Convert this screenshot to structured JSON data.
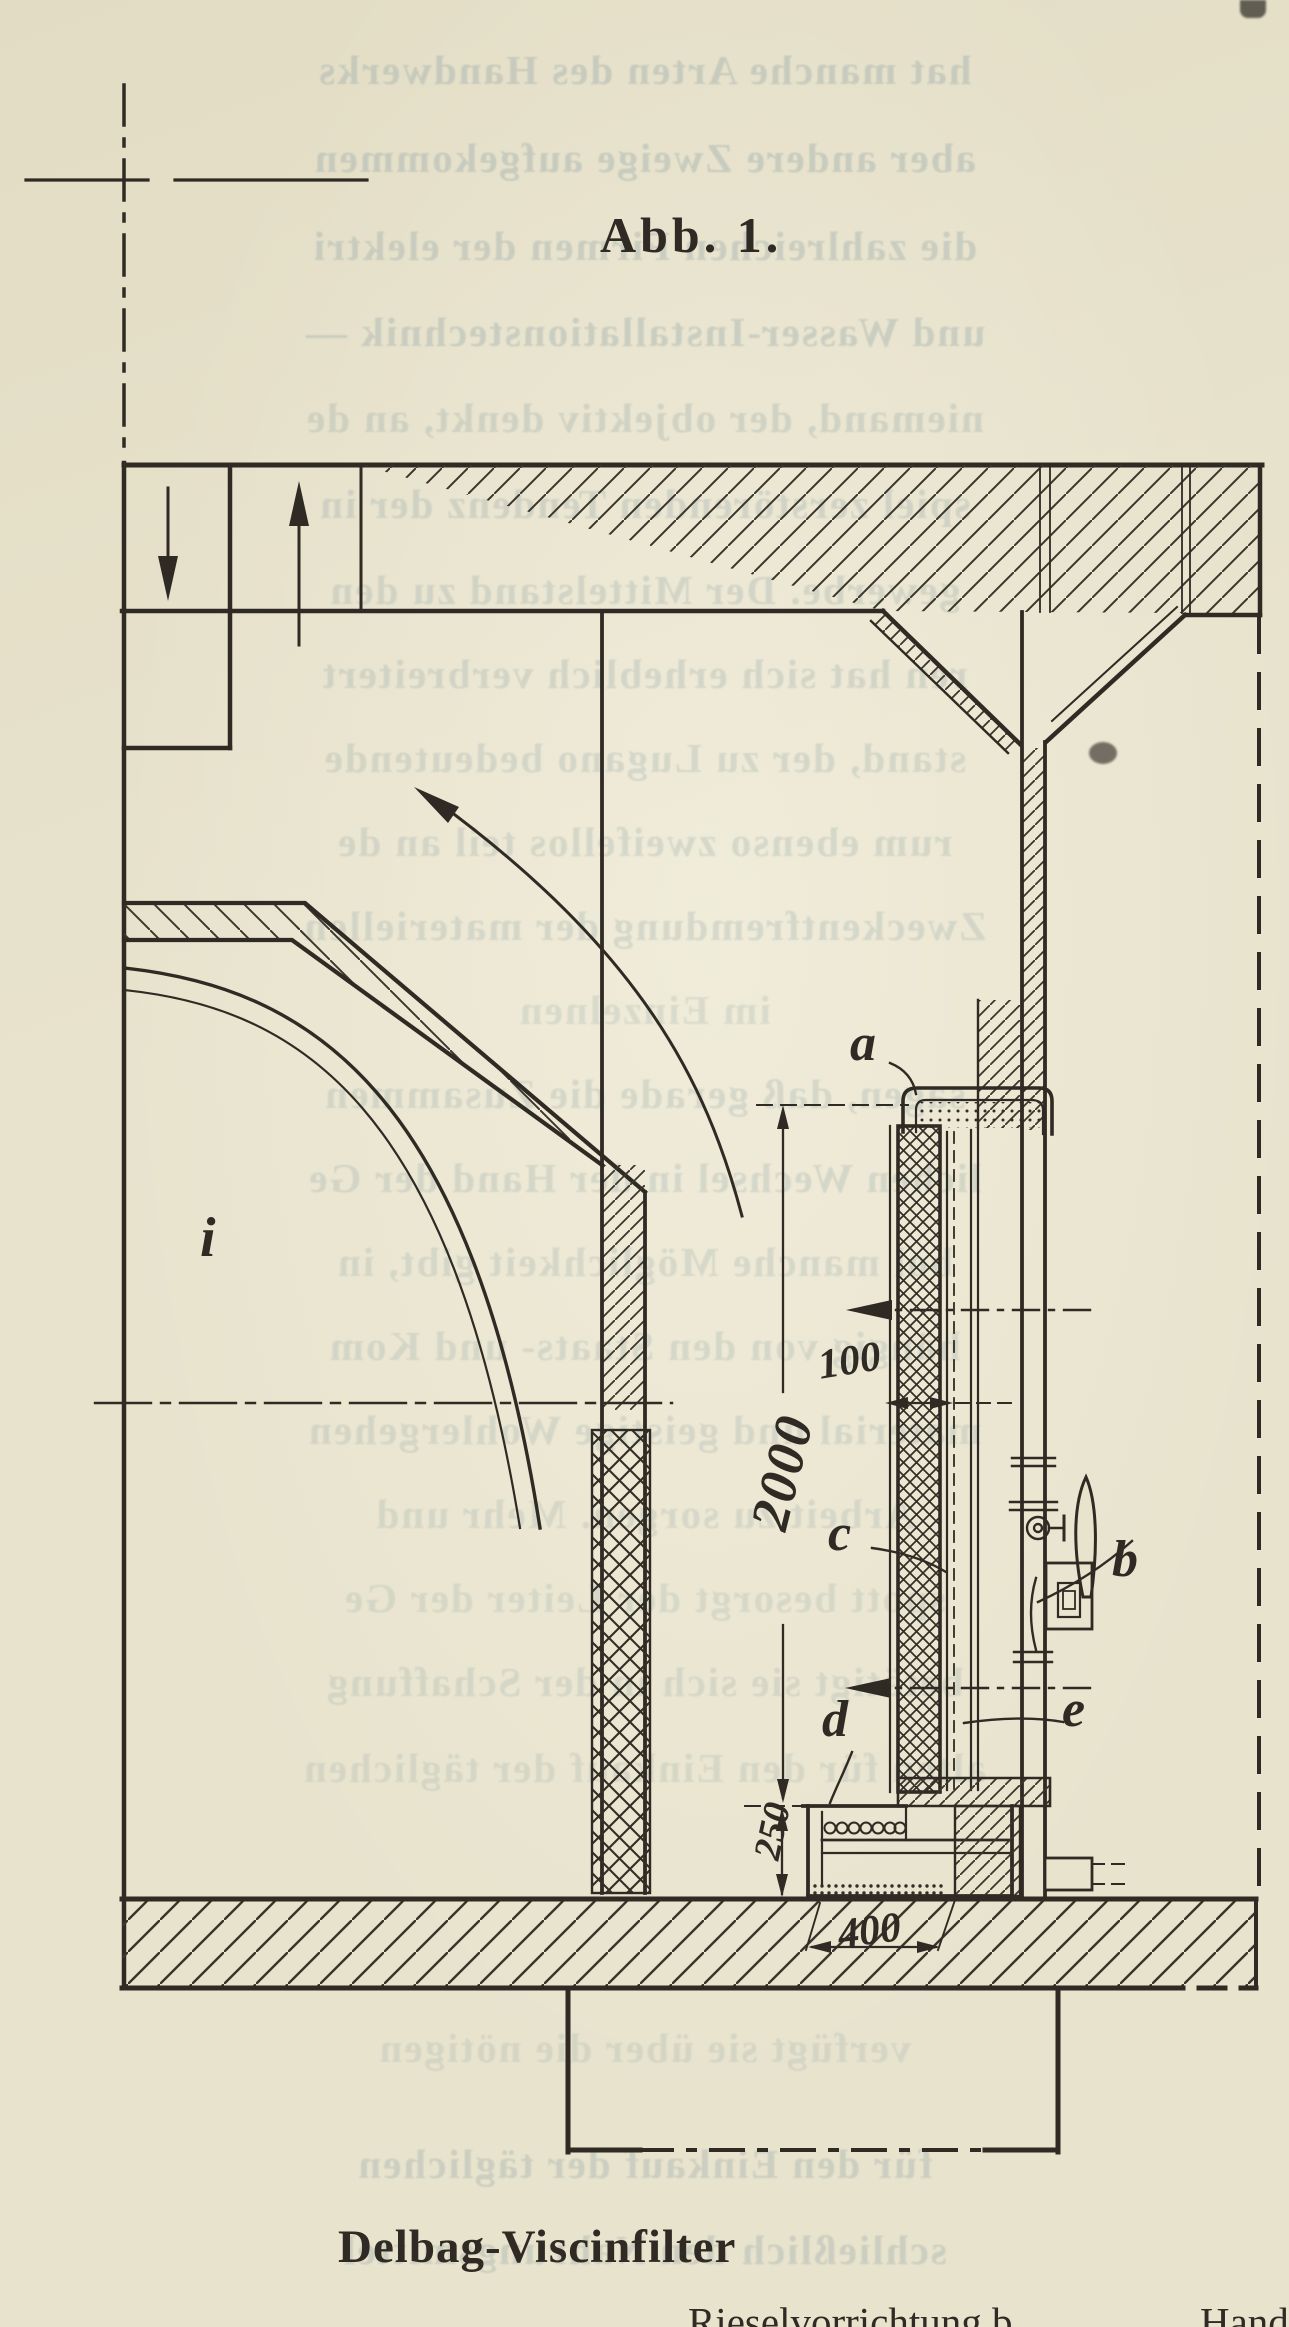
{
  "page": {
    "background_color": "#e8e3cd",
    "ink_color": "#2f2a23",
    "bleed_text_color": "#a9b6b1"
  },
  "figure": {
    "label": "Abb. 1.",
    "caption": "Delbag-Viscinfilter",
    "caption_continuation_part1": "Rieselvorrichtung b",
    "caption_continuation_part2": "Hand"
  },
  "diagram": {
    "type": "sectional engineering drawing of a Delbag Viscin air filter installed in a masonry duct",
    "part_labels": {
      "a": "a",
      "b": "b",
      "c": "c",
      "d": "d",
      "e": "e",
      "i": "i"
    },
    "dimensions_mm": {
      "filter_thickness": "100",
      "filter_height": "2000",
      "sump_height": "250",
      "trough_width": "400"
    },
    "flow_arrows": [
      "down-arrow in left shaft",
      "up-arrow in outlet shaft",
      "curved arrow from chamber to bell-mouth",
      "two horizontal arrows pointing left through filter"
    ]
  },
  "bleed_text": {
    "note": "mirrored show-through of the reverse page, German serif type",
    "lines": [
      {
        "y": 46,
        "opacity": 0.5,
        "text": "hat manche Arten des Handwerks"
      },
      {
        "y": 134,
        "opacity": 0.5,
        "text": "aber andere Zweige aufgekommen"
      },
      {
        "y": 222,
        "opacity": 0.48,
        "text": "die zahlreichen Firmen der elektri"
      },
      {
        "y": 308,
        "opacity": 0.48,
        "text": "und Wasser-Installationstechnik —"
      },
      {
        "y": 394,
        "opacity": 0.4,
        "text": "niemand, der objektiv denkt, an de"
      },
      {
        "y": 480,
        "opacity": 0.4,
        "text": "spiel zerstörenden Tendenz der in"
      },
      {
        "y": 566,
        "opacity": 0.38,
        "text": "gewerbe. Der Mittelstand zu den"
      },
      {
        "y": 650,
        "opacity": 0.38,
        "text": "ren hat sich erheblich verbreitert"
      },
      {
        "y": 734,
        "opacity": 0.36,
        "text": "stand, der zu Lugano bedeutende"
      },
      {
        "y": 818,
        "opacity": 0.36,
        "text": "rum ebenso zweifellos teil an de"
      },
      {
        "y": 902,
        "opacity": 0.36,
        "text": "Zweckentfremdung der materiellen"
      },
      {
        "y": 986,
        "opacity": 0.3,
        "text": "im Einzelnen"
      },
      {
        "y": 1070,
        "opacity": 0.36,
        "text": "sagen, daß gerade die Zusammen"
      },
      {
        "y": 1154,
        "opacity": 0.36,
        "text": "lichen Wechsel in der Hand der Ge"
      },
      {
        "y": 1238,
        "opacity": 0.34,
        "text": "bol manche Möglichkeit gibt, in"
      },
      {
        "y": 1322,
        "opacity": 0.34,
        "text": "hängig von den Staats- und Kom"
      },
      {
        "y": 1406,
        "opacity": 0.34,
        "text": "material und geistige Wohlergehen"
      },
      {
        "y": 1490,
        "opacity": 0.32,
        "text": "Arbeit zu sorgen. Mehr und"
      },
      {
        "y": 1574,
        "opacity": 0.3,
        "text": "spott besorgt der Leiter der Ge"
      },
      {
        "y": 1658,
        "opacity": 0.32,
        "text": "betätigt sie sich in der Schaffung"
      },
      {
        "y": 1744,
        "opacity": 0.3,
        "text": "alten für den Einkauf der täglichen"
      },
      {
        "y": 2024,
        "opacity": 0.3,
        "text": "verfügt sie über die nötigen"
      },
      {
        "y": 2140,
        "opacity": 0.45,
        "text": "für den Einkauf der täglichen"
      },
      {
        "y": 2226,
        "opacity": 0.45,
        "text": "schließlich den Nahrungsmittel"
      }
    ]
  }
}
